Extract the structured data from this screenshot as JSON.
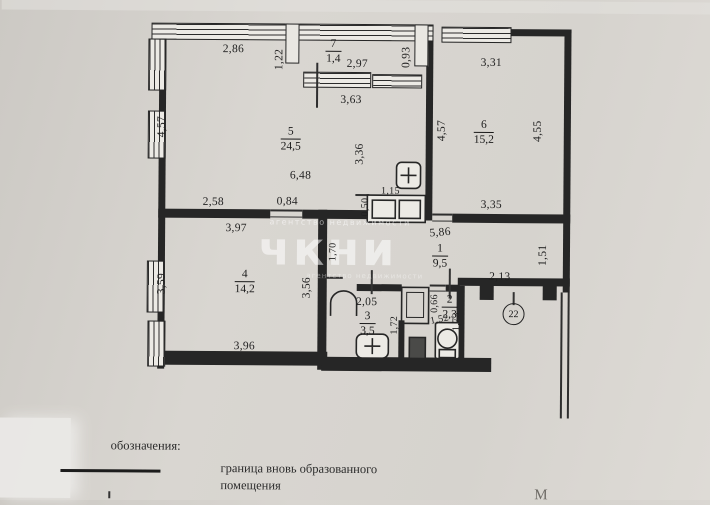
{
  "legend": {
    "title": "обозначения:",
    "items": [
      {
        "symbol": "solid-line",
        "label_line1": "граница  вновь образованного",
        "label_line2": "помещения"
      }
    ]
  },
  "watermark": {
    "small_text": "агентство недвижимости",
    "big_text": "чкни",
    "small_text2": "агентство недвижимости"
  },
  "apartment_number": "22",
  "page_letter": "М",
  "plan": {
    "rooms": [
      {
        "num": "7",
        "area": "1,4",
        "x": 332,
        "y": 52
      },
      {
        "num": "5",
        "area": "24,5",
        "x": 290,
        "y": 140
      },
      {
        "num": "6",
        "area": "15,2",
        "x": 483,
        "y": 132
      },
      {
        "num": "1",
        "area": "9,5",
        "x": 440,
        "y": 256
      },
      {
        "num": "4",
        "area": "14,2",
        "x": 245,
        "y": 283
      },
      {
        "num": "3",
        "area": "3,5",
        "x": 368,
        "y": 324
      },
      {
        "num": "2",
        "area": "2,3",
        "x": 450,
        "y": 307
      }
    ],
    "dimensions": [
      {
        "t": "2,86",
        "x": 232,
        "y": 50,
        "r": 0
      },
      {
        "t": "1,22",
        "x": 278,
        "y": 60,
        "r": -90
      },
      {
        "t": "2,97",
        "x": 356,
        "y": 64,
        "r": 0
      },
      {
        "t": "0,93",
        "x": 405,
        "y": 57,
        "r": -90
      },
      {
        "t": "3,31",
        "x": 490,
        "y": 62,
        "r": 0
      },
      {
        "t": "3,63",
        "x": 350,
        "y": 100,
        "r": 0
      },
      {
        "t": "4,57",
        "x": 161,
        "y": 128,
        "r": -90
      },
      {
        "t": "3,36",
        "x": 359,
        "y": 154,
        "r": -90
      },
      {
        "t": "4,57",
        "x": 441,
        "y": 130,
        "r": -90
      },
      {
        "t": "4,55",
        "x": 537,
        "y": 130,
        "r": -90
      },
      {
        "t": "6,48",
        "x": 300,
        "y": 176,
        "r": 0
      },
      {
        "t": "1,15",
        "x": 390,
        "y": 191,
        "r": 0,
        "s": 10
      },
      {
        "t": "0,50",
        "x": 365,
        "y": 207,
        "r": -90,
        "s": 10
      },
      {
        "t": "2,58",
        "x": 213,
        "y": 203,
        "r": 0
      },
      {
        "t": "0,84",
        "x": 287,
        "y": 202,
        "r": 0
      },
      {
        "t": "3,35",
        "x": 491,
        "y": 204,
        "r": 0
      },
      {
        "t": "3,97",
        "x": 236,
        "y": 229,
        "r": 0
      },
      {
        "t": "5,86",
        "x": 440,
        "y": 232,
        "r": -5
      },
      {
        "t": "1,51",
        "x": 543,
        "y": 254,
        "r": -90
      },
      {
        "t": "2,13",
        "x": 500,
        "y": 276,
        "r": 0
      },
      {
        "t": "3,59",
        "x": 162,
        "y": 285,
        "r": -90
      },
      {
        "t": "3,56",
        "x": 307,
        "y": 288,
        "r": -90
      },
      {
        "t": "1,70",
        "x": 333,
        "y": 252,
        "r": -90,
        "s": 10
      },
      {
        "t": "2,05",
        "x": 367,
        "y": 302,
        "r": 0
      },
      {
        "t": "1,72",
        "x": 395,
        "y": 325,
        "r": -90,
        "s": 10
      },
      {
        "t": "0,66",
        "x": 435,
        "y": 303,
        "r": -90,
        "s": 10
      },
      {
        "t": "1,52",
        "x": 440,
        "y": 319,
        "r": -12,
        "s": 10
      },
      {
        "t": "1,73",
        "x": 457,
        "y": 321,
        "r": -90,
        "s": 10
      },
      {
        "t": "3,96",
        "x": 245,
        "y": 347,
        "r": 0
      }
    ]
  }
}
